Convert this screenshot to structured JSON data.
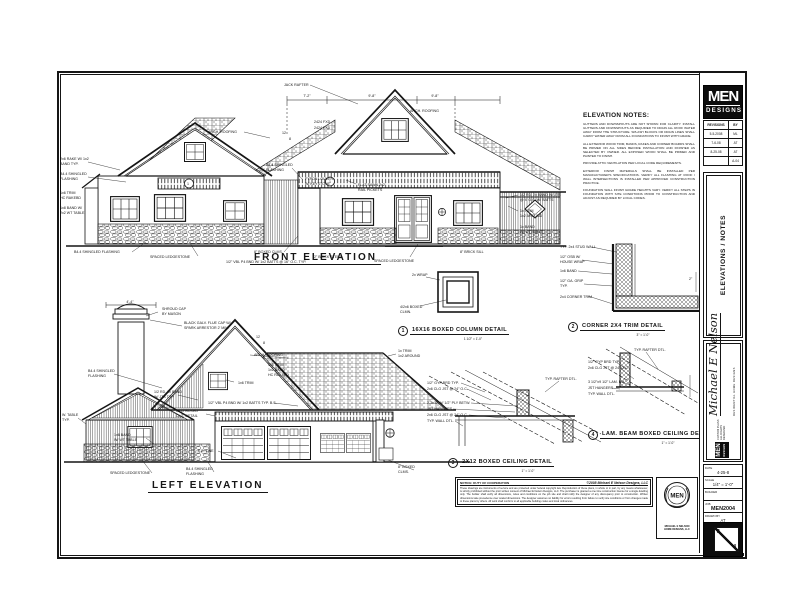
{
  "sheet": {
    "front_label": "FRONT ELEVATION",
    "left_label": "LEFT ELEVATION"
  },
  "notes": {
    "title": "ELEVATION NOTES:",
    "items": [
      "GUTTERS AND DOWNSPOUTS ARE NOT SHOWN FOR CLARITY. INSTALL GUTTERS AND DOWNSPOUTS AS REQUIRED TO DRAIN ALL ROOF WATER AWAY FROM THE STRUCTURE. SPLASH BLOCKS OR DRAIN LINES SHALL CARRY WATER AWAY FROM ALL FOUNDATIONS TO FINISH WITH GRADE.",
      "ALL EXTERIOR WOOD TRIM, BANDS, RAKES AND CORNER BOARDS SHALL BE PRIMED ON ALL SIDES BEFORE INSTALLATION AND FINISHED AS SELECTED BY OWNER. ALL EXPOSED WOOD SHALL BE PRIMED AND PAINTED TO FINISH.",
      "PROVIDE ATTIC VENTILATION PER LOCAL CODE REQUIREMENTS.",
      "EXTERIOR FINISH MATERIALS SHALL BE INSTALLED PER MANUFACTURER'S SPECIFICATIONS. VERIFY ALL FLASHING AT ROOF / WALL INTERSECTIONS IS INSTALLED PER APPROVED CONSTRUCTION PRACTICE.",
      "FOUNDATION WALL FINISH GRADE HEIGHTS VARY. VERIFY ALL STEPS IN FOUNDATION WITH SITE CONDITIONS PRIOR TO CONSTRUCTION AND ADJUST AS REQUIRED BY LOCAL CODES."
    ]
  },
  "details": [
    {
      "num": "1",
      "title": "16X16 BOXED COLUMN DETAIL",
      "scale": "1 1/2\" = 1'-0\"",
      "callouts": [
        {
          "x": 14,
          "y": 8,
          "t": "2x WRAP"
        },
        {
          "x": 2,
          "y": 40,
          "t": "4/2x6 BOXED"
        },
        {
          "x": 2,
          "y": 45,
          "t": "CLMN."
        }
      ]
    },
    {
      "num": "2",
      "title": "CORNER 2X4 TRIM DETAIL",
      "scale": "3\" = 1'-0\"",
      "callouts": [
        {
          "x": 2,
          "y": 10,
          "t": "TYP. 2x4 STUD WALL"
        },
        {
          "x": 2,
          "y": 20,
          "t": "1/2\" OSB W/"
        },
        {
          "x": 2,
          "y": 25,
          "t": "HOUSE WRAP"
        },
        {
          "x": 2,
          "y": 34,
          "t": "1x6 BAND"
        },
        {
          "x": 2,
          "y": 44,
          "t": "1/2\" GA. GRIP"
        },
        {
          "x": 2,
          "y": 49,
          "t": "TYP."
        },
        {
          "x": 2,
          "y": 60,
          "t": "2x4 CORNER TRIM"
        },
        {
          "x": 131,
          "y": 42,
          "t": "2\""
        }
      ]
    },
    {
      "num": "3",
      "title": "2X12 BOXED CEILING DETAIL",
      "scale": "1\" = 1'-0\"",
      "callouts": [
        {
          "x": 2,
          "y": 14,
          "t": "1/2\" GYP BRD TYP."
        },
        {
          "x": 2,
          "y": 20,
          "t": "2x6 CLG JST @ 24\" O.C."
        },
        {
          "x": 2,
          "y": 34,
          "t": "2-2x12 W/ 1/2\" PLY BETW."
        },
        {
          "x": 2,
          "y": 40,
          "t": "JST HANGERS"
        },
        {
          "x": 2,
          "y": 46,
          "t": "2x6 CLG JST @ 24\" O.C."
        },
        {
          "x": 2,
          "y": 52,
          "t": "TYP. WALL DTL."
        },
        {
          "x": 120,
          "y": 10,
          "t": "TYP. RAFTER DTL."
        }
      ]
    },
    {
      "num": "4",
      "title": "LAM. BEAM BOXED CEILING DETAIL",
      "scale": "1\" = 1'-0\"",
      "callouts": [
        {
          "x": 48,
          "y": 6,
          "t": "TYP. RAFTER DTL."
        },
        {
          "x": 2,
          "y": 18,
          "t": "1/2\" GYP BRD TYP."
        },
        {
          "x": 2,
          "y": 24,
          "t": "2x6 CLG JST @ 24\" O.C."
        },
        {
          "x": 2,
          "y": 38,
          "t": "3 1/2\"x9 1/2\" LAM. BM."
        },
        {
          "x": 2,
          "y": 44,
          "t": "JST HANGERS"
        },
        {
          "x": 2,
          "y": 50,
          "t": "TYP. WALL DTL."
        }
      ]
    }
  ],
  "front_elevation": {
    "callouts": [
      {
        "x": 226,
        "y": 10,
        "t": "JACK RAFTER"
      },
      {
        "x": 249,
        "y": 21,
        "t": "7'-2\"",
        "a": "middle"
      },
      {
        "x": 314,
        "y": 21,
        "t": "9'-8\"",
        "a": "middle"
      },
      {
        "x": 377,
        "y": 21,
        "t": "9'-8\"",
        "a": "middle"
      },
      {
        "x": 150,
        "y": 57,
        "t": "ARCH. ROOFING"
      },
      {
        "x": 352,
        "y": 36,
        "t": "ARCH. ROOFING"
      },
      {
        "x": 256,
        "y": 47,
        "t": "2424 FXD"
      },
      {
        "x": 256,
        "y": 53,
        "t": "2424 FXD"
      },
      {
        "x": 2,
        "y": 84,
        "t": "2x6 RAKE W/ 1x2"
      },
      {
        "x": 2,
        "y": 89,
        "t": "BAND TYP."
      },
      {
        "x": 2,
        "y": 99,
        "t": "B4.4 SHINGLED"
      },
      {
        "x": 2,
        "y": 104,
        "t": "FLASHING"
      },
      {
        "x": 2,
        "y": 118,
        "t": "1x6 TRIM"
      },
      {
        "x": 2,
        "y": 123,
        "t": "HC RAKEBD"
      },
      {
        "x": 2,
        "y": 133,
        "t": "1x8 BAND W/"
      },
      {
        "x": 2,
        "y": 138,
        "t": "2x2 WT TABLE"
      },
      {
        "x": 208,
        "y": 90,
        "t": "B4.4 SHINGLED"
      },
      {
        "x": 208,
        "y": 95,
        "t": "FLASHING"
      },
      {
        "x": 247,
        "y": 104,
        "t": "FYPON LOUVER"
      },
      {
        "x": 247,
        "y": 109,
        "t": "W/ KEYSTONE"
      },
      {
        "x": 300,
        "y": 110,
        "t": "FLAT SAWN 2x2"
      },
      {
        "x": 300,
        "y": 115,
        "t": "RAIL PICKETS"
      },
      {
        "x": 462,
        "y": 120,
        "t": "1/2 RD. 2x BAND W/ JTS"
      },
      {
        "x": 462,
        "y": 125,
        "t": "@ 4' O.C. W/ BATTS"
      },
      {
        "x": 462,
        "y": 136,
        "t": "1x TRIM"
      },
      {
        "x": 462,
        "y": 141,
        "t": "1x2 AROUND"
      },
      {
        "x": 462,
        "y": 152,
        "t": "1x BAND"
      },
      {
        "x": 462,
        "y": 157,
        "t": "W/ WT TABLE"
      },
      {
        "x": 16,
        "y": 177,
        "t": "B4.4 SHINGLED FLASHING"
      },
      {
        "x": 92,
        "y": 182,
        "t": "SPACED LEDGESTONE"
      },
      {
        "x": 196,
        "y": 177,
        "t": "8\" BOXED CLMS."
      },
      {
        "x": 256,
        "y": 182,
        "t": "2\" BRICK STEPS"
      },
      {
        "x": 316,
        "y": 186,
        "t": "SPACED LEDGESTONE"
      },
      {
        "x": 402,
        "y": 177,
        "t": "8\" BRICK SILL"
      },
      {
        "x": 168,
        "y": 187,
        "t": "1/2\" VBL P4 BND W/ 1x2 BATTS @ 16\" O.C. TYP."
      },
      {
        "x": 130,
        "y": 109,
        "t": "1",
        "a": "middle"
      },
      {
        "x": 272,
        "y": 107,
        "t": "1",
        "a": "middle"
      },
      {
        "x": 224,
        "y": 58,
        "t": "12"
      },
      {
        "x": 231,
        "y": 64,
        "t": "8"
      }
    ]
  },
  "left_elevation": {
    "callouts": [
      {
        "x": 72,
        "y": 7,
        "t": "4'-4\"",
        "a": "middle"
      },
      {
        "x": 104,
        "y": 14,
        "t": "SHROUD CAP"
      },
      {
        "x": 104,
        "y": 19,
        "t": "BY MASON"
      },
      {
        "x": 126,
        "y": 28,
        "t": "BLACK GALV. FLUE CAP W/"
      },
      {
        "x": 126,
        "y": 33,
        "t": "SPARK ARRESTOR 2' MIN."
      },
      {
        "x": 196,
        "y": 60,
        "t": "ARCH. ROOFING"
      },
      {
        "x": 30,
        "y": 76,
        "t": "B4.4 SHINGLED"
      },
      {
        "x": 30,
        "y": 81,
        "t": "FLASHING"
      },
      {
        "x": 180,
        "y": 88,
        "t": "1x6 TRIM"
      },
      {
        "x": 210,
        "y": 70,
        "t": "1x6 TRIM"
      },
      {
        "x": 210,
        "y": 75,
        "t": "1x2 BAND"
      },
      {
        "x": 210,
        "y": 80,
        "t": "HC RAKEBD"
      },
      {
        "x": 96,
        "y": 97,
        "t": "1/2 RD. 2x BAND"
      },
      {
        "x": 96,
        "y": 102,
        "t": "W/ JTS TYP."
      },
      {
        "x": 150,
        "y": 108,
        "t": "1/2\" VBL P4 BND W/ 1x2 BATTS TYP. B.S."
      },
      {
        "x": 118,
        "y": 116,
        "t": "2X12 BOXED"
      },
      {
        "x": 118,
        "y": 121,
        "t": "CLG. DETAIL"
      },
      {
        "x": 340,
        "y": 56,
        "t": "1x TRIM"
      },
      {
        "x": 340,
        "y": 61,
        "t": "1x2 AROUND"
      },
      {
        "x": 4,
        "y": 120,
        "t": "W. TABLE"
      },
      {
        "x": 4,
        "y": 125,
        "t": "TYP."
      },
      {
        "x": 56,
        "y": 140,
        "t": "1x6 BAND"
      },
      {
        "x": 56,
        "y": 145,
        "t": "W/ WT TABLE"
      },
      {
        "x": 140,
        "y": 156,
        "t": "F.G. LINE"
      },
      {
        "x": 52,
        "y": 178,
        "t": "SPACED LEDGESTONE"
      },
      {
        "x": 128,
        "y": 174,
        "t": "B4.4 SHINGLED"
      },
      {
        "x": 128,
        "y": 179,
        "t": "FLASHING"
      },
      {
        "x": 340,
        "y": 172,
        "t": "8\" BOXED"
      },
      {
        "x": 340,
        "y": 177,
        "t": "CLMS."
      },
      {
        "x": 198,
        "y": 42,
        "t": "12"
      },
      {
        "x": 205,
        "y": 48,
        "t": "8"
      }
    ]
  },
  "titleblock": {
    "logo_top": "MEN",
    "logo_bottom": "DESIGNS",
    "revisions": {
      "header": [
        "REVISIONS",
        "BY"
      ],
      "rows": [
        [
          "5-5-2008",
          "ML"
        ],
        [
          "7-6-08",
          "AT"
        ],
        [
          "8-25-08",
          "AT"
        ],
        [
          "",
          "A-04"
        ]
      ]
    },
    "sheet_title": "ELEVATIONS / NOTES",
    "signature": {
      "name": "Michael E Nelson",
      "band": "RESIDENTIAL HOME DESIGNS",
      "line1": "CUSTOM PLANS",
      "line2": "ALL RIGHTS RESERVED",
      "logo_top": "MEN",
      "logo_bottom": "DESIGNS"
    },
    "info": {
      "date_label": "DATE",
      "date": "4-25-8",
      "scale_label": "SCALE",
      "scale": "1/4\" = 1'-0\"",
      "builder_label": "BUILDER",
      "builder": "",
      "job_label": "JOB",
      "job": "MEN2004",
      "drawn_label": "DRAWN BY",
      "drawn": "AT"
    },
    "sheet_no": {
      "top": "2",
      "bottom": "4"
    }
  },
  "copyright": {
    "heading_left": "NOTICE: DUTY OF COOPERATION",
    "heading_right": "©2008 Michael E Nelson Designs, LLC",
    "body": "These drawings are instruments of service and are protected under federal copyright law. Reproduction of these plans, in whole or in part, by any means whatsoever, is strictly prohibited without the prior written consent of Michael E Nelson Designs, LLC. The purchaser is granted a one time construction license for a single dwelling only. The builder shall verify all dimensions, notes and conditions on the job site and shall notify the designer of any discrepancy prior to construction. Written dimensions take precedence over scaled dimensions. The designer assumes no liability for errors resulting from failure to verify site conditions or from changes made to these plans by others. All work shall conform to all applicable building codes and local ordinances."
  },
  "seal": {
    "text": "MEN",
    "caption1": "MICHAEL E NELSON",
    "caption2": "HOME DESIGNS, LLC"
  }
}
